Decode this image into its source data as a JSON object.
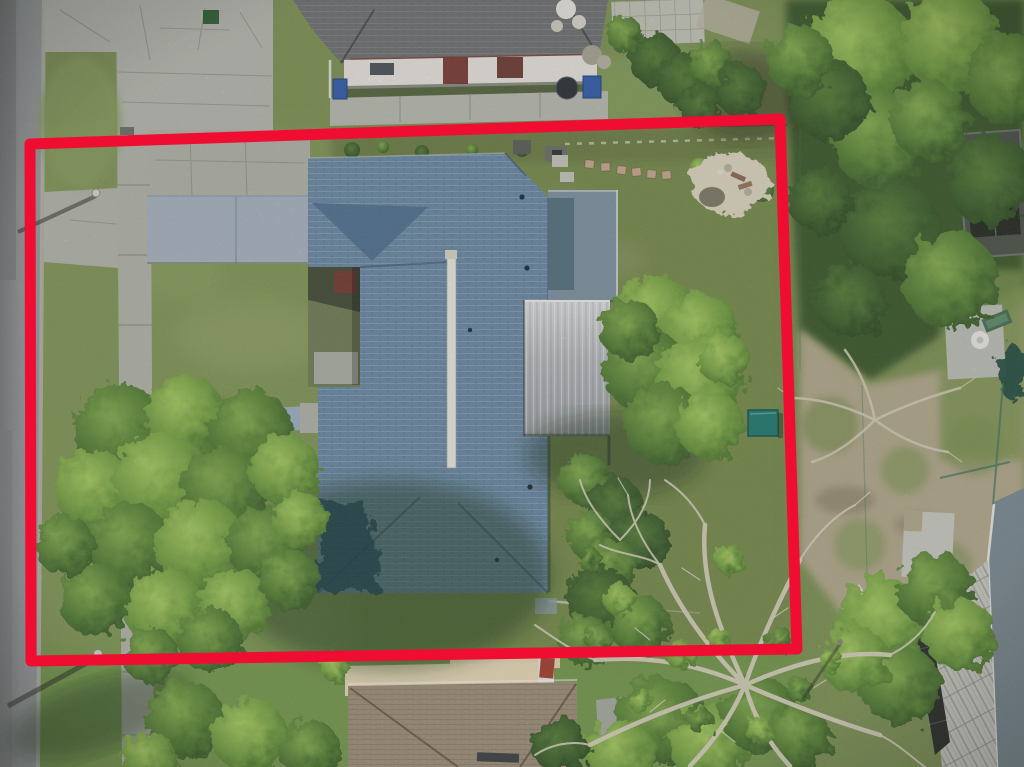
{
  "title": "Aerial drone photo of a residential parcel outlined with a red property boundary",
  "boundary": {
    "color": "#ef0e31",
    "stroke_width": 11,
    "corners": [
      [
        30,
        144
      ],
      [
        780,
        119
      ],
      [
        797,
        649
      ],
      [
        31,
        661
      ]
    ]
  },
  "colors": {
    "grass": "#7d9254",
    "grass_bright": "#74a24c",
    "grass_dark": "#3f5c33",
    "road": "#8f9294",
    "curb": "#b5b8b0",
    "sidewalk": "#b3b5ab",
    "concrete": "#b6b8af",
    "driveway": "#a7b3c0",
    "walkway": "#9db0c2",
    "dirt": "#b3a98c",
    "sand": "#ded8c2",
    "roof_main": "#6a89a5",
    "roof_main_dark": "#4f7090",
    "roof_navy_shadow": "#1f4468",
    "ridge_vent": "#eceade",
    "roof_flat": "#7e93a2",
    "roof_flat_dark": "#54717f",
    "charcoal_roof": "#6f7072",
    "white_wall": "#e9e6df",
    "door_red": "#7a3a33",
    "bin_blue": "#2f5cae",
    "tan_roof": "#9d8d79",
    "cream_wall": "#e8d9b8",
    "teal_shed": "#1f7a70",
    "canopy_bright": "#8cba52",
    "canopy_mid": "#5f8c3a",
    "canopy_dark": "#34552a",
    "branch_silver": "#d8d2bf",
    "planks": "#c9cbc3",
    "screen_dark": "#2a2c28",
    "pool_roof": "#7b8a93",
    "table_white": "#ebebe6",
    "chair_green": "#466e52",
    "grill_red": "#a33f2e"
  },
  "scene": {
    "road": "asphalt street along left edge",
    "sidewalk": "concrete sidewalk strip",
    "driveway": "smooth blue-gray driveway slab",
    "subject_house": "blue-gray shingle hip roof with white ridge vent",
    "flat_roof": "gray flat roof section on right of house",
    "metal_roof": "silver metal roof section",
    "neighbor_top": "charcoal shingle roof house with red door and blue bins",
    "neighbor_bottom": "tan shingle hip roof house with cream wall",
    "firepit": "sandy patch with stone fire pit in backyard",
    "shed": "small teal shed in backyard",
    "dead_tree": "large leafless tree with silver branches",
    "patio": "concrete patio with white table and green lounge chair"
  }
}
